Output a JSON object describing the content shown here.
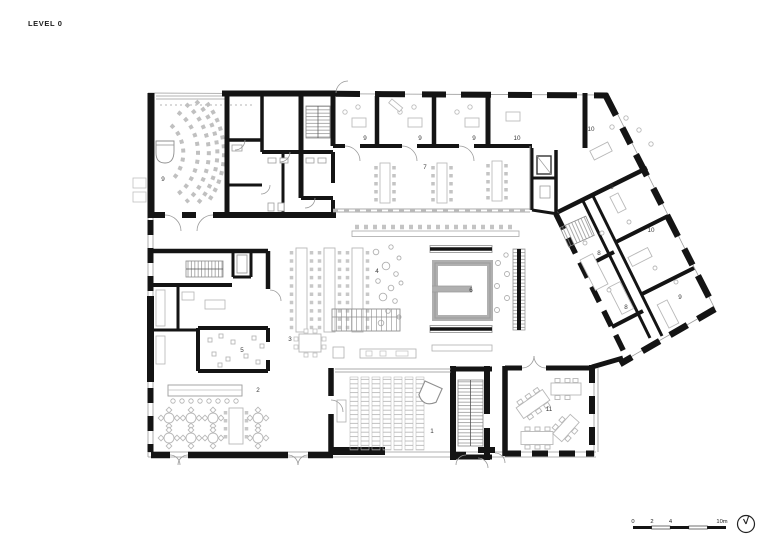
{
  "title": "LEVEL 0",
  "plan": {
    "rooms": [
      {
        "label": "9"
      },
      {
        "label": "9"
      },
      {
        "label": "9"
      },
      {
        "label": "9"
      },
      {
        "label": "10"
      },
      {
        "label": "10"
      },
      {
        "label": "7"
      },
      {
        "label": "9"
      },
      {
        "label": "10"
      },
      {
        "label": "8"
      },
      {
        "label": "8"
      },
      {
        "label": "9"
      },
      {
        "label": "4"
      },
      {
        "label": "6"
      },
      {
        "label": "3"
      },
      {
        "label": "5"
      },
      {
        "label": "2"
      },
      {
        "label": "1"
      },
      {
        "label": "11"
      }
    ]
  },
  "scalebar": {
    "t0": "0",
    "t2": "2",
    "t4": "4",
    "t10": "10m"
  },
  "icons": {
    "north_indicator": "north-arrow-icon"
  },
  "colors": {
    "wall": "#141414",
    "thin_line": "#8f8f8f",
    "furniture": "#c0c0c0",
    "text": "#3a3a3a"
  }
}
